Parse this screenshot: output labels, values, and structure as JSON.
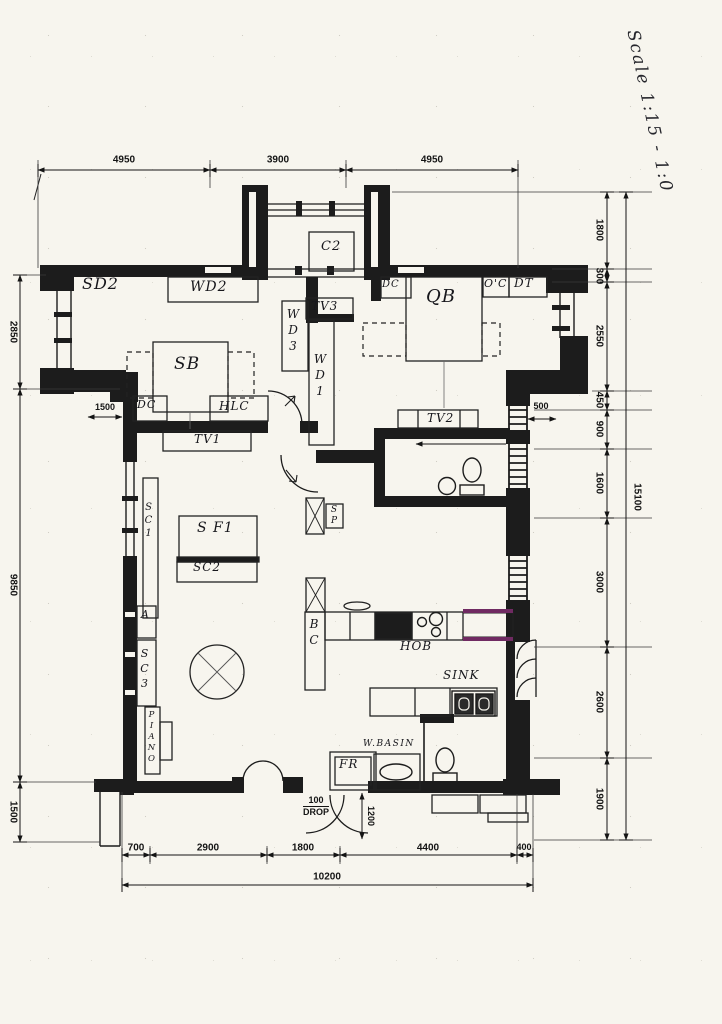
{
  "colors": {
    "ink": "#1c1c1c",
    "paper": "#f7f5ee",
    "accent": "#702a62"
  },
  "scale_note": "Scale 1:15 - 1:0",
  "dims": {
    "top": [
      "4950",
      "3900",
      "4950"
    ],
    "right": [
      "1800",
      "300",
      "2550",
      "450",
      "900",
      "1600",
      "3000",
      "2600",
      "1900"
    ],
    "right_total": "15100",
    "left": [
      "2850",
      "9850",
      "1500"
    ],
    "bottom": [
      "700",
      "2900",
      "1800",
      "4400",
      "400"
    ],
    "bottom_total": "10200",
    "offset_left": "1500",
    "offset_right": "500",
    "door_width": "1200",
    "drop_value": "100",
    "drop_label": "DROP"
  },
  "labels": {
    "sd2": "SD2",
    "wd2": "WD2",
    "c2": "C2",
    "dc_bedroom2": "DC",
    "hlc": "HLC",
    "tv1": "TV1",
    "sb": "SB",
    "dc_master": "DC",
    "qb": "QB",
    "oc": "O'C",
    "dt": "DT",
    "tv3": "TV3",
    "wd3": "WD3",
    "wd1": "WD1",
    "tv2": "TV2",
    "sc1": "SC1",
    "sf1": "S F1",
    "sc2": "SC2",
    "sp": "SP",
    "bc": "BC",
    "hob": "HOB",
    "sink": "SINK",
    "a": "A",
    "sc3": "SC3",
    "piano": "PIANO",
    "fr": "FR",
    "wbasin": "W.BASIN"
  }
}
